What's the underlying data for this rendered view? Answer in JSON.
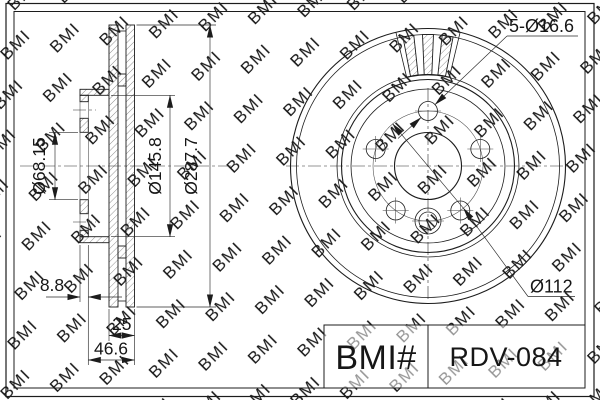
{
  "watermark": {
    "text": "BMI",
    "color": "#c4c4c4"
  },
  "drawing": {
    "section_view": {
      "bore_diameter_label": "Ø68.15",
      "hat_diameter_label": "Ø145.8",
      "outer_diameter_label": "Ø287.7",
      "hat_thickness_label": "8.8",
      "friction_ring_width_label": "25",
      "total_width_label": "46.6"
    },
    "front_view": {
      "bolt_holes_label": "5-Ø16.6",
      "bolt_circle_label": "Ø112"
    }
  },
  "title_block": {
    "brand": "BMI#",
    "part_number": "RDV-084"
  },
  "colors": {
    "line": "#1c1c1c",
    "background": "#ffffff",
    "watermark": "#c4c4c4"
  }
}
